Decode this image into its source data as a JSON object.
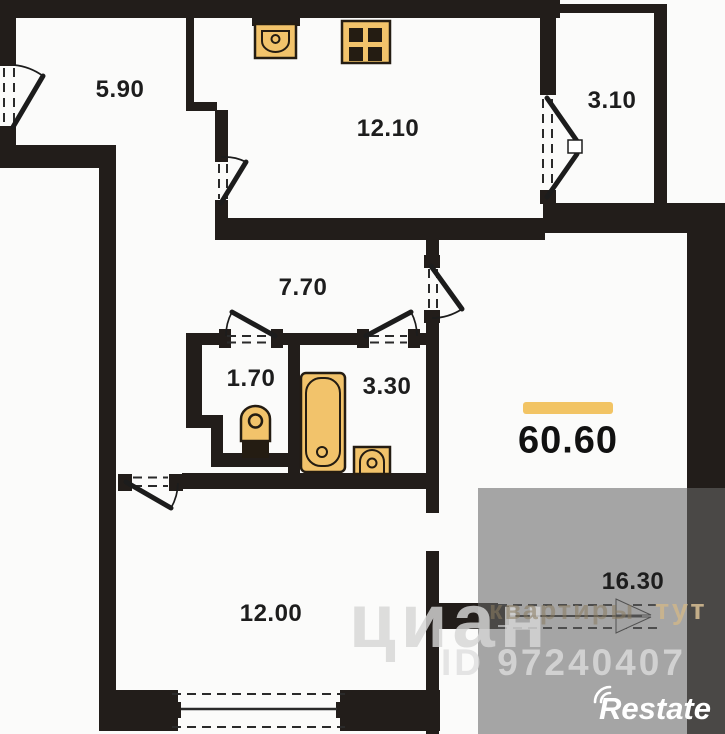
{
  "rooms": {
    "hall": {
      "area": "5.90"
    },
    "kitchen": {
      "area": "12.10"
    },
    "balcony": {
      "area": "3.10"
    },
    "corridor": {
      "area": "7.70"
    },
    "wc": {
      "area": "1.70"
    },
    "bathroom": {
      "area": "3.30"
    },
    "bedroom": {
      "area": "12.00"
    },
    "living_room": {
      "area": "16.30"
    }
  },
  "total": {
    "area": "60.60"
  },
  "watermark": {
    "brand": "циан",
    "slogan_word1": "квартиры",
    "slogan_word2": "тут",
    "listing_id": "ID 97240407",
    "provider": "Restate"
  },
  "colors": {
    "wall": "#221d1a",
    "fixture_fill": "#f2c36b",
    "fixture_line": "#241c12",
    "accent_bar": "#f2c464",
    "overlay": "rgba(104,104,104,0.58)",
    "watermark_gray": "#d6d6d6"
  }
}
